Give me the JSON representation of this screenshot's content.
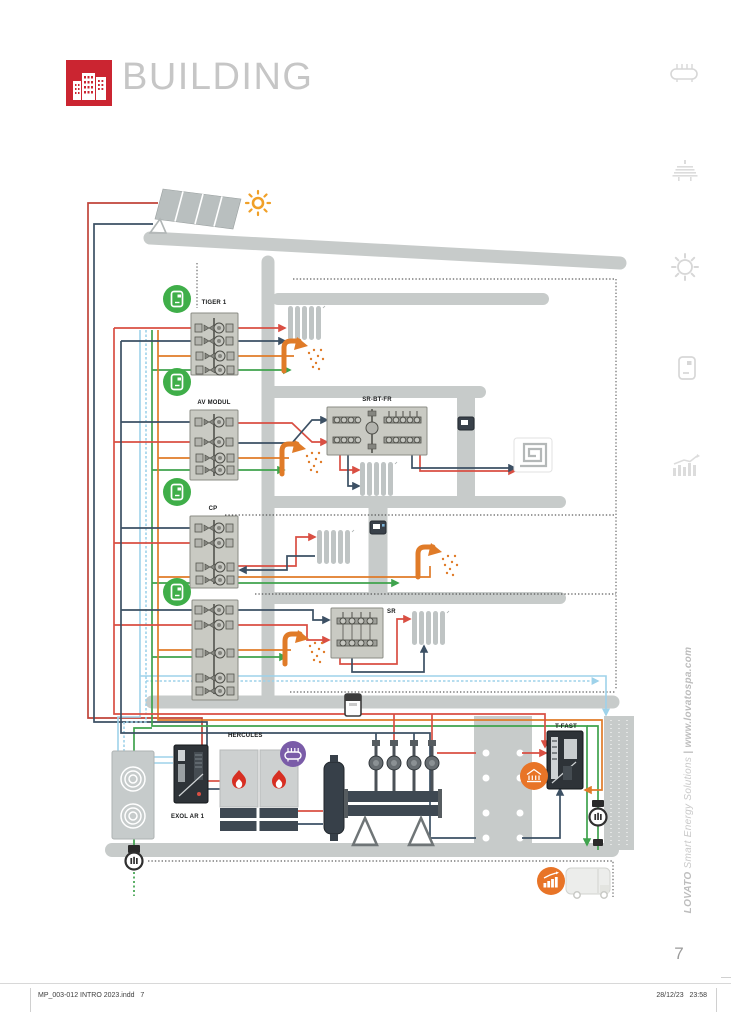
{
  "header": {
    "title": "BUILDING",
    "logo_color": "#cb2531",
    "logo_icon": "building-skyline-icon"
  },
  "page": {
    "number": "7"
  },
  "footer": {
    "left": "MP_003-012 INTRO 2023.indd   7",
    "right": "28/12/23   23:58"
  },
  "brand_sidebar": {
    "name": "LOVATO",
    "tagline": " Smart Energy Solutions ",
    "separator": "|",
    "url": " www.lovatospa.com"
  },
  "sidebar_icons": [
    {
      "name": "manifold-icon"
    },
    {
      "name": "solar-collector-icon"
    },
    {
      "name": "sun-icon"
    },
    {
      "name": "controller-icon"
    },
    {
      "name": "chart-icon"
    }
  ],
  "diagram": {
    "units": {
      "tiger": {
        "label": "TIGER 1"
      },
      "av_modul": {
        "label": "AV MODUL"
      },
      "sr_bt_fr": {
        "label": "SR-BT-FR"
      },
      "cp": {
        "label": "CP"
      },
      "sr": {
        "label": "SR"
      },
      "hercules": {
        "label": "HERCULES"
      },
      "exol": {
        "label": "EXOL AR 1"
      },
      "t_fast": {
        "label": "T-FAST"
      }
    },
    "icons": [
      "sun-icon",
      "solar-panel",
      "green-controller-icon",
      "shower-icon",
      "radiator",
      "underfloor-heating-icon",
      "thermostat",
      "purple-manifold-badge",
      "orange-building-badge",
      "orange-chart-badge",
      "gas-meter-icon",
      "energy-meter-icon",
      "heat-pump-unit",
      "boiler-flame-icon",
      "delivery-truck-icon"
    ],
    "pipe_colors": {
      "solar_supply": "#c0443a",
      "heating_supply": "#d94f43",
      "heating_return": "#3c5064",
      "cold_water": "#9ed2ea",
      "gas": "#3fa34d",
      "dhw": "#e07b28"
    },
    "accent_colors": {
      "controller_green": "#3fae49",
      "boiler_flame": "#d72f23",
      "badge_purple": "#7a5ca8",
      "badge_orange": "#e87427",
      "wall_gray": "#c7cbca"
    }
  }
}
